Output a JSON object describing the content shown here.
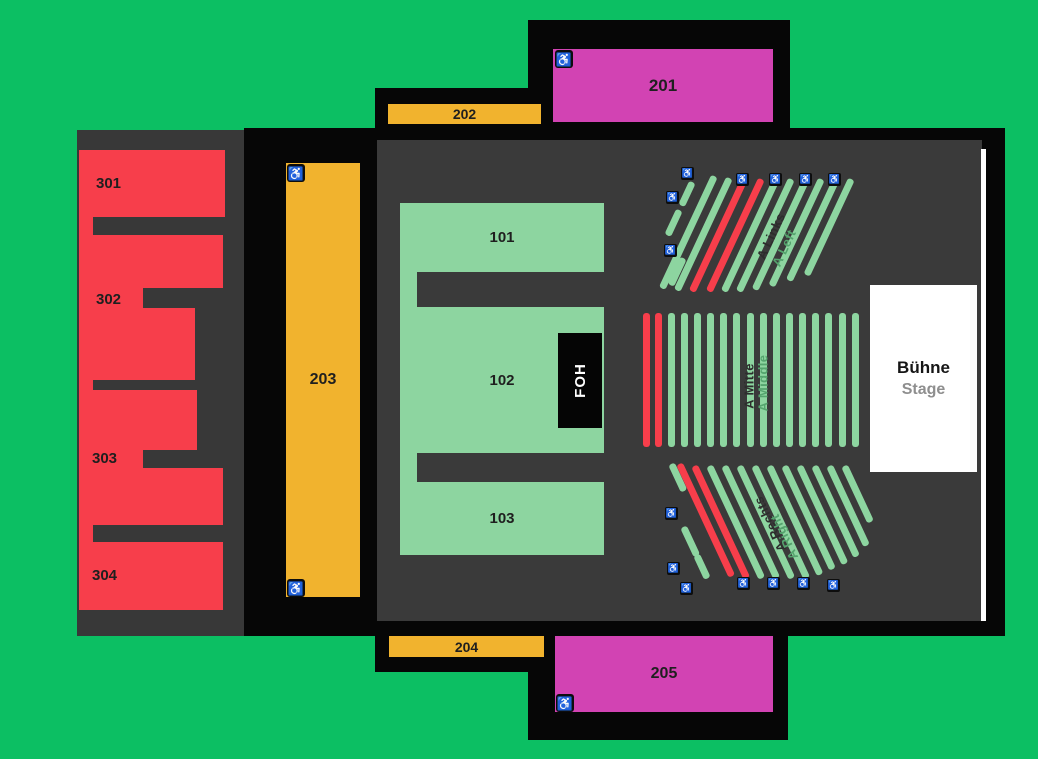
{
  "colors": {
    "background": "#0CBF63",
    "building": "#060606",
    "floor": "#383838",
    "red": "#F73E4B",
    "orange": "#F1B32E",
    "magenta": "#D243B3",
    "seat_green": "#8DD5A0",
    "white": "#FFFFFF",
    "label_dark": "#1F1F1F",
    "label_green": "#55A46E",
    "stage_subtitle": "#8E8E8E"
  },
  "icons": {
    "wheelchair": "♿"
  },
  "blocks": {
    "101": "101",
    "102": "102",
    "103": "103",
    "201": "201",
    "202": "202",
    "203": "203",
    "204": "204",
    "205": "205",
    "301": "301",
    "302": "302",
    "303": "303",
    "304": "304"
  },
  "foh": {
    "label": "FOH"
  },
  "stage": {
    "title": "Bühne",
    "subtitle": "Stage"
  },
  "sections": {
    "links": {
      "name_de": "A Links",
      "name_en": "A Left",
      "stripes": [
        {
          "x": 44,
          "y": 24,
          "l": 26,
          "c": "g"
        },
        {
          "x": 31,
          "y": 52,
          "l": 28,
          "c": "g"
        },
        {
          "x": 35,
          "y": 100,
          "l": 30,
          "c": "g"
        },
        {
          "x": 66,
          "y": 18,
          "l": 124,
          "c": "g"
        },
        {
          "x": 81,
          "y": 20,
          "l": 124,
          "c": "g"
        },
        {
          "x": 96,
          "y": 21,
          "l": 124,
          "c": "r"
        },
        {
          "x": 113,
          "y": 21,
          "l": 124,
          "c": "r"
        },
        {
          "x": 128,
          "y": 21,
          "l": 124,
          "c": "g"
        },
        {
          "x": 143,
          "y": 21,
          "l": 124,
          "c": "g"
        },
        {
          "x": 158,
          "y": 21,
          "l": 122,
          "c": "g"
        },
        {
          "x": 173,
          "y": 21,
          "l": 118,
          "c": "g"
        },
        {
          "x": 188,
          "y": 21,
          "l": 112,
          "c": "g"
        },
        {
          "x": 203,
          "y": 21,
          "l": 106,
          "c": "g"
        }
      ],
      "icons": [
        {
          "x": 36,
          "y": 9
        },
        {
          "x": 21,
          "y": 33
        },
        {
          "x": 19,
          "y": 86
        },
        {
          "x": 91,
          "y": 15
        },
        {
          "x": 124,
          "y": 15
        },
        {
          "x": 154,
          "y": 15
        },
        {
          "x": 183,
          "y": 15
        }
      ]
    },
    "mitte": {
      "name_de": "A Mitte",
      "name_en": "A Middle",
      "stripes": [
        {
          "x": 0,
          "y": 0,
          "l": 134,
          "c": "r"
        },
        {
          "x": 12,
          "y": 0,
          "l": 134,
          "c": "r"
        },
        {
          "x": 25,
          "y": 0,
          "l": 134,
          "c": "g"
        },
        {
          "x": 38,
          "y": 0,
          "l": 134,
          "c": "g"
        },
        {
          "x": 51,
          "y": 0,
          "l": 134,
          "c": "g"
        },
        {
          "x": 64,
          "y": 0,
          "l": 134,
          "c": "g"
        },
        {
          "x": 77,
          "y": 0,
          "l": 134,
          "c": "g"
        },
        {
          "x": 90,
          "y": 0,
          "l": 134,
          "c": "g"
        },
        {
          "x": 104,
          "y": 0,
          "l": 134,
          "c": "g"
        },
        {
          "x": 117,
          "y": 0,
          "l": 134,
          "c": "g"
        },
        {
          "x": 130,
          "y": 0,
          "l": 134,
          "c": "g"
        },
        {
          "x": 143,
          "y": 0,
          "l": 134,
          "c": "g"
        },
        {
          "x": 156,
          "y": 0,
          "l": 134,
          "c": "g"
        },
        {
          "x": 169,
          "y": 0,
          "l": 134,
          "c": "g"
        },
        {
          "x": 182,
          "y": 0,
          "l": 134,
          "c": "g"
        },
        {
          "x": 196,
          "y": 0,
          "l": 134,
          "c": "g"
        },
        {
          "x": 209,
          "y": 0,
          "l": 134,
          "c": "g"
        }
      ],
      "icons": []
    },
    "rechts": {
      "name_de": "A Rechts",
      "name_en": "A Right",
      "stripes": [
        {
          "x": 23,
          "y": 9,
          "l": 30,
          "c": "g"
        },
        {
          "x": 31,
          "y": 9,
          "l": 124,
          "c": "r"
        },
        {
          "x": 46,
          "y": 11,
          "l": 124,
          "c": "r"
        },
        {
          "x": 61,
          "y": 11,
          "l": 124,
          "c": "g"
        },
        {
          "x": 76,
          "y": 11,
          "l": 124,
          "c": "g"
        },
        {
          "x": 91,
          "y": 11,
          "l": 124,
          "c": "g"
        },
        {
          "x": 106,
          "y": 11,
          "l": 124,
          "c": "g"
        },
        {
          "x": 121,
          "y": 11,
          "l": 120,
          "c": "g"
        },
        {
          "x": 136,
          "y": 11,
          "l": 114,
          "c": "g"
        },
        {
          "x": 151,
          "y": 11,
          "l": 108,
          "c": "g"
        },
        {
          "x": 166,
          "y": 11,
          "l": 100,
          "c": "g"
        },
        {
          "x": 181,
          "y": 11,
          "l": 88,
          "c": "g"
        },
        {
          "x": 196,
          "y": 11,
          "l": 62,
          "c": "g"
        },
        {
          "x": 35,
          "y": 72,
          "l": 32,
          "c": "g"
        },
        {
          "x": 48,
          "y": 100,
          "l": 26,
          "c": "g"
        }
      ],
      "icons": [
        {
          "x": 20,
          "y": 52
        },
        {
          "x": 22,
          "y": 107
        },
        {
          "x": 35,
          "y": 127
        },
        {
          "x": 92,
          "y": 122
        },
        {
          "x": 122,
          "y": 122
        },
        {
          "x": 152,
          "y": 122
        },
        {
          "x": 182,
          "y": 124
        }
      ]
    }
  }
}
